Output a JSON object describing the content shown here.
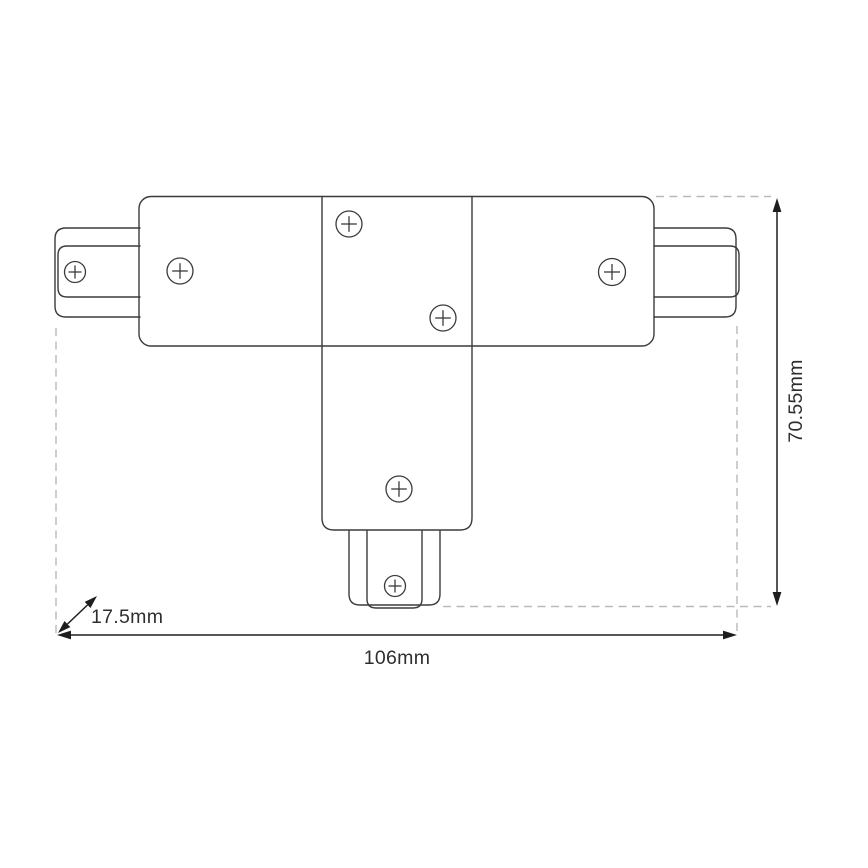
{
  "colors": {
    "background": "#ffffff",
    "outline": "#3b3b3f",
    "dashed": "#b9b9b9",
    "dimension": "#1e1e1e",
    "text": "#2e2e2e"
  },
  "drawing": {
    "type": "technical-dimension-drawing",
    "subject": "t-shaped-track-connector-top-view",
    "dimensions": {
      "width_label": "106mm",
      "height_label": "70.55mm",
      "depth_label": "17.5mm"
    },
    "screw_symbol": "circled-plus",
    "screw_count": 7
  }
}
